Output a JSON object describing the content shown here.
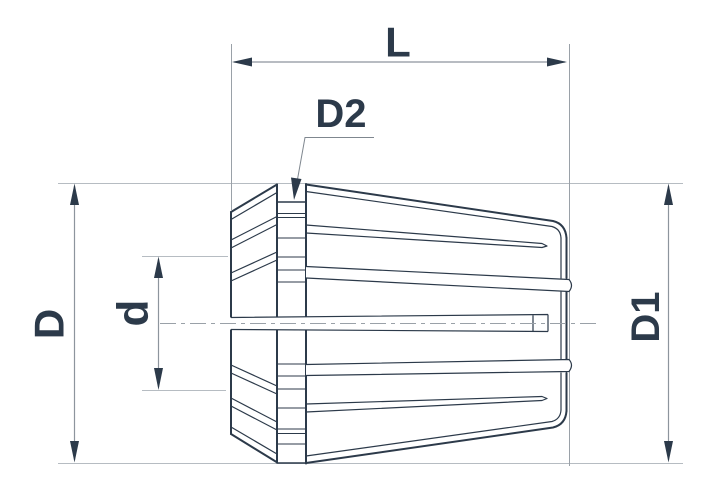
{
  "drawing": {
    "title": "ER collet dimension drawing",
    "labels": {
      "overall_length": "L",
      "neck_diameter": "D2",
      "front_diameter": "D",
      "bore_diameter": "d",
      "body_diameter": "D1"
    },
    "colors": {
      "line_dark": "#2c3a4a",
      "dimension_line": "#8d959d",
      "extension_line": "#b6bcc2",
      "background": "#ffffff"
    }
  }
}
